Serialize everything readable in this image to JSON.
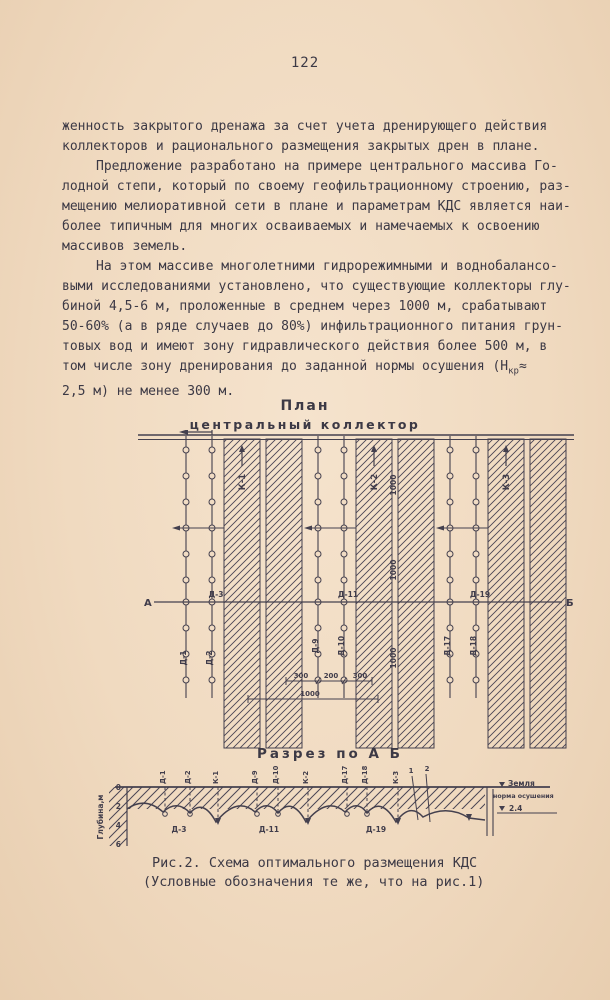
{
  "page": {
    "number": "122"
  },
  "body": {
    "lines": [
      {
        "t": "женность закрытого дренажа за счет учета дренирующего действия"
      },
      {
        "t": "коллекторов и рационального размещения закрытых дрен в плане."
      },
      {
        "t": "Предложение разработано на примере центрального массива Го-"
      },
      {
        "t": "лодной степи, который по своему геофильтрационному строению, раз-"
      },
      {
        "t": "мещению мелиоративной сети в плане и параметрам КДС является наи-"
      },
      {
        "t": "более типичным для многих осваиваемых и намечаемых к освоению"
      },
      {
        "t": "массивов земель."
      },
      {
        "t": "На этом массиве многолетними гидрорежимными и воднобалансо-"
      },
      {
        "t": "выми исследованиями установлено, что существующие коллекторы глу-"
      },
      {
        "t": "биной 4,5-6 м, проложенные в среднем через 1000 м, срабатывают"
      },
      {
        "t": "50-60% (а в ряде случаев до 80%) инфильтрационного питания грун-"
      },
      {
        "t": "товых вод и имеют зону гидравлического действия более 500 м, в"
      },
      {
        "t": "том числе зону дренирования до заданной нормы осушения (Н",
        "sub": "кр",
        "t2": "≈"
      },
      {
        "t": "2,5 м) не менее 300 м."
      }
    ]
  },
  "plan": {
    "title": "План",
    "collector_label": "центральный коллектор",
    "collectors": [
      "К-1",
      "К-2",
      "К-3"
    ],
    "drains_top": [
      "Д-1",
      "Д-2",
      "Д-9",
      "Д-10",
      "Д-17",
      "Д-18"
    ],
    "section_line": {
      "start": "А",
      "end": "Б",
      "drains": [
        "Д-3",
        "Д-11",
        "Д-19"
      ]
    },
    "spacing_label": "1000",
    "dims": {
      "d300a": "300",
      "d200": "200",
      "d300b": "300",
      "d1000": "1000"
    }
  },
  "section": {
    "title": "Разрез по А Б",
    "depth_axis": {
      "label": "Глубина,м",
      "ticks": [
        "0",
        "2",
        "4",
        "6"
      ]
    },
    "top_labels": [
      "Д-1",
      "Д-2",
      "К-1",
      "Д-9",
      "Д-10",
      "К-2",
      "Д-17",
      "Д-18",
      "К-3"
    ],
    "line_numbers": [
      "1",
      "2"
    ],
    "ground_label": "Земля",
    "norm_label": "норма осушения",
    "norm_value": "2.4",
    "bottom_labels": [
      "Д-3",
      "Д-11",
      "Д-19"
    ]
  },
  "caption": {
    "line1": "Рис.2. Схема оптимального размещения КДС",
    "line2": "(Условные обозначения те же, что на рис.1)"
  },
  "colors": {
    "paper": "#f0dac0",
    "ink": "#413d4b"
  }
}
